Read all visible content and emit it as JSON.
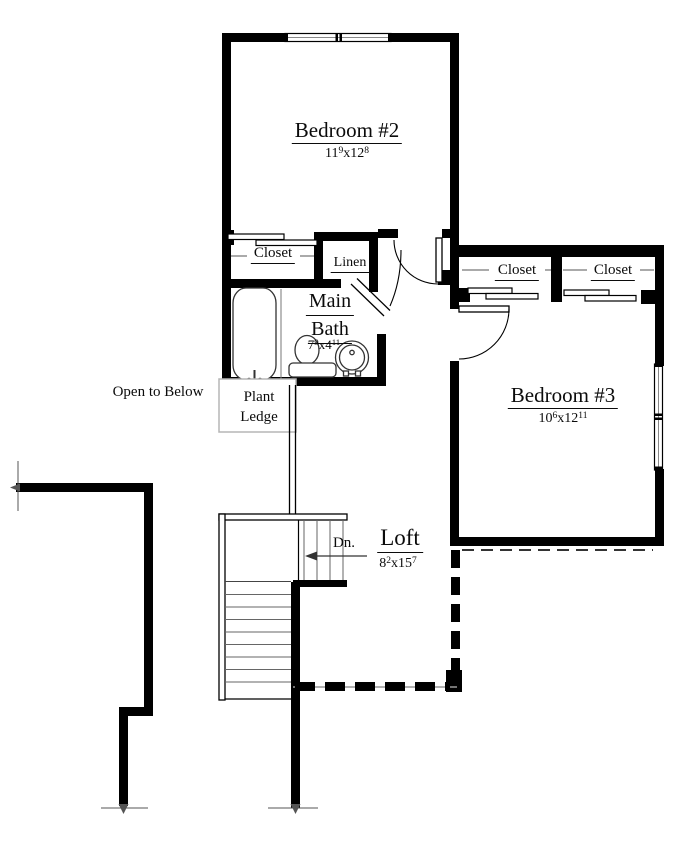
{
  "plan": {
    "bedroom2": {
      "name": "Bedroom #2",
      "dim": {
        "w": "11",
        "w_sup": "9",
        "sep": "x",
        "l": "12",
        "l_sup": "8"
      }
    },
    "bedroom3": {
      "name": "Bedroom #3",
      "dim": {
        "w": "10",
        "w_sup": "6",
        "sep": "x",
        "l": "12",
        "l_sup": "11"
      }
    },
    "main_bath": {
      "name_line1": "Main",
      "name_line2": "Bath",
      "dim": {
        "w": "7",
        "w_sup": "9",
        "sep": "x",
        "l": "4",
        "l_sup": "11"
      }
    },
    "loft": {
      "name": "Loft",
      "dim": {
        "w": "8",
        "w_sup": "2",
        "sep": "x",
        "l": "15",
        "l_sup": "7"
      }
    },
    "closets": {
      "bedroom2_closet": "Closet",
      "linen": "Linen",
      "bedroom3_closet_left": "Closet",
      "bedroom3_closet_right": "Closet"
    },
    "annotations": {
      "open_to_below": "Open to Below",
      "plant_ledge_line1": "Plant",
      "plant_ledge_line2": "Ledge",
      "stairs_down": "Dn."
    }
  }
}
